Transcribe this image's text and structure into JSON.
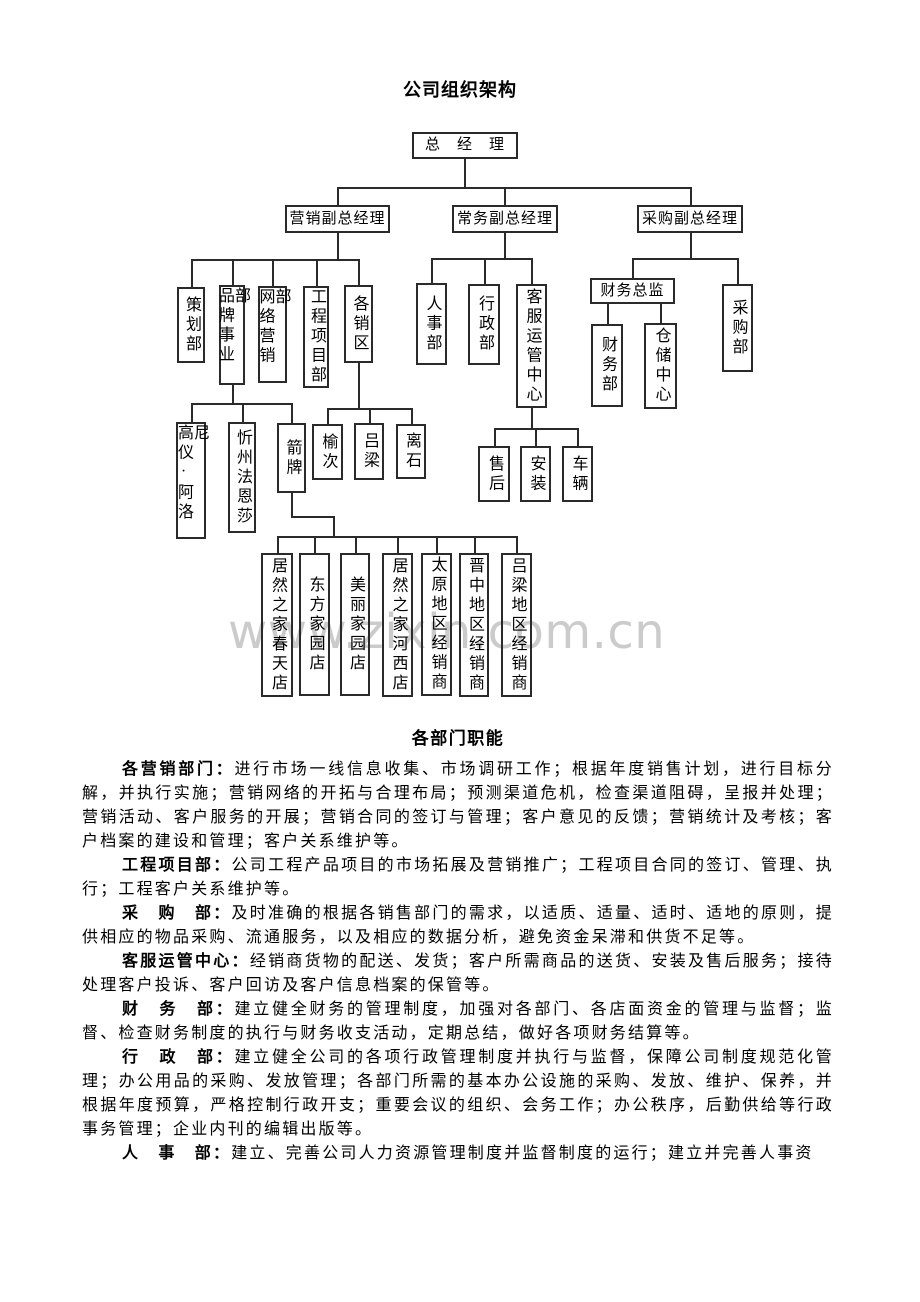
{
  "page": {
    "title": "公司组织架构",
    "watermark": "www.zixin.com.cn"
  },
  "org": {
    "nodes": [
      {
        "label": "总　经　理"
      },
      {
        "label": "营销副总经理"
      },
      {
        "label": "常务副总经理"
      },
      {
        "label": "采购副总经理"
      },
      {
        "label": "策划部"
      },
      {
        "label": "品牌事业部"
      },
      {
        "label": "网络营销部"
      },
      {
        "label": "工程项目部"
      },
      {
        "label": "各销区"
      },
      {
        "label": "人事部"
      },
      {
        "label": "行政部"
      },
      {
        "label": "客服运管中心"
      },
      {
        "label": "财务总监"
      },
      {
        "label": "财务部"
      },
      {
        "label": "仓储中心"
      },
      {
        "label": "采购部"
      },
      {
        "label": "高仪·阿洛尼"
      },
      {
        "label": "忻州法恩莎"
      },
      {
        "label": "箭牌"
      },
      {
        "label": "榆次"
      },
      {
        "label": "吕梁"
      },
      {
        "label": "离石"
      },
      {
        "label": "售后"
      },
      {
        "label": "安装"
      },
      {
        "label": "车辆"
      },
      {
        "label": "居然之家春天店"
      },
      {
        "label": "东方家园店"
      },
      {
        "label": "美丽家园店"
      },
      {
        "label": "居然之家河西店"
      },
      {
        "label": "太原地区经销商"
      },
      {
        "label": "晋中地区经销商"
      },
      {
        "label": "吕梁地区经销商"
      }
    ]
  },
  "functions": {
    "title": "各部门职能",
    "paragraphs": [
      {
        "label": "各营销部门：",
        "text": "进行市场一线信息收集、市场调研工作；根据年度销售计划，进行目标分解，并执行实施；营销网络的开拓与合理布局；预测渠道危机，检查渠道阻碍，呈报并处理；营销活动、客户服务的开展；营销合同的签订与管理；客户意见的反馈；营销统计及考核；客户档案的建设和管理；客户关系维护等。"
      },
      {
        "label": "工程项目部：",
        "text": "公司工程产品项目的市场拓展及营销推广；工程项目合同的签订、管理、执行；工程客户关系维护等。"
      },
      {
        "label": "采　购　部：",
        "text": "及时准确的根据各销售部门的需求，以适质、适量、适时、适地的原则，提供相应的物品采购、流通服务，以及相应的数据分析，避免资金呆滞和供货不足等。"
      },
      {
        "label": "客服运管中心：",
        "text": "经销商货物的配送、发货；客户所需商品的送货、安装及售后服务；接待处理客户投诉、客户回访及客户信息档案的保管等。"
      },
      {
        "label": "财　务　部：",
        "text": "建立健全财务的管理制度，加强对各部门、各店面资金的管理与监督；监督、检查财务制度的执行与财务收支活动，定期总结，做好各项财务结算等。"
      },
      {
        "label": "行　政　部：",
        "text": "建立健全公司的各项行政管理制度并执行与监督，保障公司制度规范化管理；办公用品的采购、发放管理；各部门所需的基本办公设施的采购、发放、维护、保养，并根据年度预算，严格控制行政开支；重要会议的组织、会务工作；办公秩序，后勤供给等行政事务管理；企业内刊的编辑出版等。"
      },
      {
        "label": "人　事　部：",
        "text": "建立、完善公司人力资源管理制度并监督制度的运行；建立并完善人事资"
      }
    ]
  }
}
